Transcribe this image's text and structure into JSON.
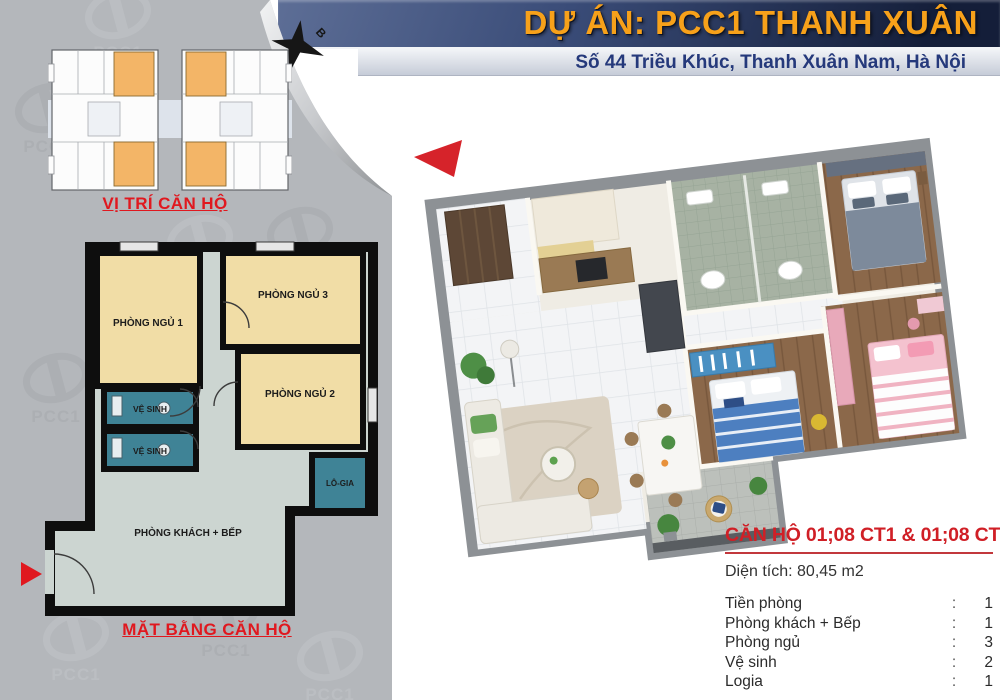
{
  "header": {
    "title": "DỰ ÁN: PCC1 THANH XUÂN",
    "address": "Số 44 Triều Khúc, Thanh Xuân Nam, Hà Nội"
  },
  "sidebar": {
    "brand": "PCC1",
    "compass_label": "B",
    "unit_location_caption": "VỊ TRÍ CĂN HỘ",
    "floor_plan_caption": "MẶT BẰNG CĂN HỘ",
    "floor_plan_rooms": {
      "bedroom_1": "PHÒNG NGỦ 1",
      "bedroom_3": "PHÒNG NGỦ 3",
      "bedroom_2": "PHÒNG NGỦ 2",
      "bathroom_upper": "VỆ SINH",
      "bathroom_lower": "VỆ SINH",
      "loggia": "LÔ-GIA",
      "living_kitchen": "PHÒNG KHÁCH + BẾP"
    }
  },
  "info_panel": {
    "title": "CĂN HỘ 01;08 CT1 & 01;08 CT2",
    "area": "Diện tích: 80,45 m2",
    "rows": [
      {
        "label": "Tiền phòng",
        "separator": ":",
        "value": "1"
      },
      {
        "label": "Phòng khách + Bếp",
        "separator": ":",
        "value": "1"
      },
      {
        "label": "Phòng ngủ",
        "separator": ":",
        "value": "3"
      },
      {
        "label": "Vệ sinh",
        "separator": ":",
        "value": "2"
      },
      {
        "label": "Logia",
        "separator": ":",
        "value": "1"
      }
    ]
  },
  "colors": {
    "header_navy": "#1c2a4a",
    "accent_orange": "#f7a11a",
    "accent_red": "#e0181f",
    "sidebar_gray": "#b4b7bb",
    "plan_room_cream": "#f1dda6",
    "plan_room_teal": "#3f8396",
    "plan_hall_gray": "#ccd5d1",
    "site_unit_highlight": "#f3b567"
  }
}
